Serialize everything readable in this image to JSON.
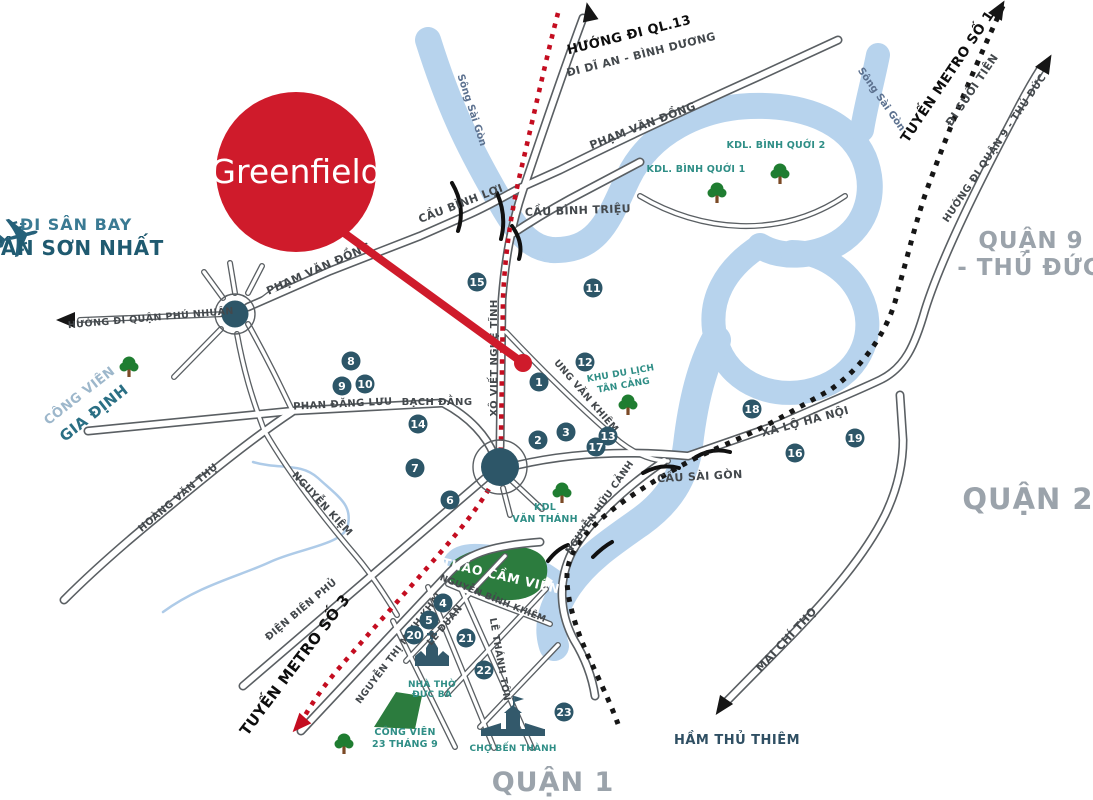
{
  "project": {
    "name": "Greenfield"
  },
  "icons": {
    "airplane": "✈"
  },
  "colors": {
    "accent_red": "#cf1b2b",
    "metro_red": "#c40d20",
    "metro_black": "#161616",
    "river_blue": "#b7d3ed",
    "park_green": "#2c7c3e",
    "marker_teal": "#2d5668",
    "place_teal": "#2f8e86",
    "district_gray": "#9ba3ab"
  },
  "labels": [
    {
      "name": "district-quan-1",
      "t": "QUẬN 1",
      "x": 553,
      "y": 791,
      "r": 0,
      "c": "district",
      "s": 27
    },
    {
      "name": "district-quan-2",
      "t": "QUẬN 2",
      "x": 1028,
      "y": 509,
      "r": 0,
      "c": "district",
      "s": 29
    },
    {
      "name": "district-quan-9-line1",
      "t": "QUẬN 9",
      "x": 1031,
      "y": 248,
      "r": 0,
      "c": "district",
      "s": 23
    },
    {
      "name": "district-quan-9-line2",
      "t": "- THỦ ĐỨC",
      "x": 1029,
      "y": 275,
      "r": 0,
      "c": "district",
      "s": 23
    },
    {
      "name": "airport-direction-line1",
      "t": "ĐI SÂN BAY",
      "x": 76,
      "y": 230,
      "r": 0,
      "c": "tsn1",
      "s": 16,
      "a": "start"
    },
    {
      "name": "airport-direction-line2",
      "t": "TÂN SƠN NHẤT",
      "x": 76,
      "y": 255,
      "r": 0,
      "c": "tsn2",
      "s": 20,
      "a": "start"
    },
    {
      "name": "ql13-direction-line1",
      "t": "HƯỚNG ĐI QL.13",
      "x": 630,
      "y": 39,
      "r": -14,
      "c": "black",
      "s": 13
    },
    {
      "name": "ql13-direction-line2",
      "t": "ĐI DĨ AN - BÌNH DƯƠNG",
      "x": 642,
      "y": 58,
      "r": -14,
      "c": "road",
      "s": 11
    },
    {
      "name": "metro1-label-line1",
      "t": "TUYẾN METRO SỐ 1",
      "x": 951,
      "y": 79,
      "r": -56,
      "c": "black",
      "s": 13.5
    },
    {
      "name": "metro1-label-line2",
      "t": "ĐI SUỐI TIÊN",
      "x": 975,
      "y": 92,
      "r": -56,
      "c": "road",
      "s": 11
    },
    {
      "name": "metro3-label",
      "t": "TUYẾN METRO SỐ 3",
      "x": 299,
      "y": 668,
      "r": -53,
      "c": "black",
      "s": 15
    },
    {
      "name": "quan9-direction",
      "t": "HƯỚNG ĐI QUẬN 9 - THỦ ĐỨC",
      "x": 997,
      "y": 150,
      "r": -56,
      "c": "road",
      "s": 10
    },
    {
      "name": "phu-nhuan-direction",
      "t": "HƯỚNG ĐI QUẬN PHÚ NHUẬN",
      "x": 151,
      "y": 321,
      "r": -5,
      "c": "road",
      "s": 9.5
    },
    {
      "name": "thu-thiem-tunnel-label",
      "t": "HẦM THỦ THIÊM",
      "x": 737,
      "y": 744,
      "r": 0,
      "c": "tunnel",
      "s": 13
    },
    {
      "name": "road-pham-van-dong-1",
      "t": "PHẠM VĂN ĐỒNG",
      "x": 320,
      "y": 272,
      "r": -24,
      "c": "road",
      "s": 11
    },
    {
      "name": "road-pham-van-dong-2",
      "t": "PHẠM VĂN ĐỒNG",
      "x": 644,
      "y": 129,
      "r": -21,
      "c": "road",
      "s": 11
    },
    {
      "name": "bridge-cau-binh-loi",
      "t": "CẦU BÌNH LỢI",
      "x": 462,
      "y": 207,
      "r": -21,
      "c": "road",
      "s": 11
    },
    {
      "name": "bridge-cau-binh-trieu",
      "t": "CẦU BÌNH TRIỆU",
      "x": 578,
      "y": 214,
      "r": -2,
      "c": "road",
      "s": 11
    },
    {
      "name": "road-xo-viet-nghe-tinh",
      "t": "XÔ VIẾT NGHỆ TĨNH",
      "x": 497,
      "y": 358,
      "r": -90,
      "c": "road",
      "s": 10
    },
    {
      "name": "road-phan-dang-luu",
      "t": "PHAN ĐĂNG LƯU",
      "x": 343,
      "y": 407,
      "r": -3,
      "c": "road",
      "s": 10
    },
    {
      "name": "road-bach-dang",
      "t": "BẠCH ĐẰNG",
      "x": 437,
      "y": 405,
      "r": 0,
      "c": "road",
      "s": 10
    },
    {
      "name": "road-hoang-van-thu",
      "t": "HOÀNG VĂN THỤ",
      "x": 180,
      "y": 500,
      "r": -40,
      "c": "road",
      "s": 10
    },
    {
      "name": "road-nguyen-kiem",
      "t": "NGUYỄN KIỆM",
      "x": 320,
      "y": 506,
      "r": 47,
      "c": "road",
      "s": 10
    },
    {
      "name": "road-dien-bien-phu",
      "t": "ĐIỆN BIÊN PHỦ",
      "x": 303,
      "y": 612,
      "r": -40,
      "c": "road",
      "s": 10
    },
    {
      "name": "road-nguyen-thi-minh-khai",
      "t": "NGUYỄN THỊ MINH KHAI",
      "x": 401,
      "y": 650,
      "r": -53,
      "c": "road",
      "s": 9.5
    },
    {
      "name": "road-le-duan",
      "t": "LÊ DUẨN",
      "x": 447,
      "y": 627,
      "r": -50,
      "c": "road",
      "s": 9.5
    },
    {
      "name": "road-nguyen-binh-khiem",
      "t": "NGUYỄN BỈNH KHIÊM",
      "x": 492,
      "y": 601,
      "r": 22,
      "c": "road",
      "s": 9
    },
    {
      "name": "road-le-thanh-ton",
      "t": "LÊ THÁNH TÔN",
      "x": 497,
      "y": 660,
      "r": 80,
      "c": "road",
      "s": 9.5
    },
    {
      "name": "road-ung-van-khiem",
      "t": "UNG VĂN KHIÊM",
      "x": 584,
      "y": 398,
      "r": 49,
      "c": "road",
      "s": 9.5
    },
    {
      "name": "road-nguyen-huu-canh",
      "t": "NGUYỄN HỮU CẢNH",
      "x": 602,
      "y": 509,
      "r": -55,
      "c": "road",
      "s": 9.5
    },
    {
      "name": "bridge-cau-sai-gon",
      "t": "CẦU SÀI GÒN",
      "x": 700,
      "y": 480,
      "r": -3,
      "c": "road",
      "s": 11
    },
    {
      "name": "road-xa-lo-ha-noi",
      "t": "XA LỘ HÀ NỘI",
      "x": 806,
      "y": 425,
      "r": -15,
      "c": "road",
      "s": 11
    },
    {
      "name": "road-mai-chi-tho",
      "t": "MAI CHÍ THỌ",
      "x": 789,
      "y": 642,
      "r": -47,
      "c": "road",
      "s": 11
    },
    {
      "name": "river-song-sai-gon-1",
      "t": "Sông Sài Gòn",
      "x": 469,
      "y": 111,
      "r": 72,
      "c": "river-lb",
      "s": 10
    },
    {
      "name": "river-song-sai-gon-2",
      "t": "Sông Sài Gòn",
      "x": 879,
      "y": 101,
      "r": 55,
      "c": "river-lb",
      "s": 10
    },
    {
      "name": "place-kdl-binh-quoi-1",
      "t": "KDL. BÌNH QUỚI 1",
      "x": 696,
      "y": 172,
      "r": 0,
      "c": "place",
      "s": 9.5
    },
    {
      "name": "place-kdl-binh-quoi-2",
      "t": "KDL. BÌNH QUỚI 2",
      "x": 776,
      "y": 148,
      "r": 0,
      "c": "place",
      "s": 9.5
    },
    {
      "name": "place-kdl-tan-cang-line1",
      "t": "KHU DU LỊCH",
      "x": 621,
      "y": 376,
      "r": -10,
      "c": "place",
      "s": 9
    },
    {
      "name": "place-kdl-tan-cang-line2",
      "t": "TÂN CẢNG",
      "x": 624,
      "y": 388,
      "r": -10,
      "c": "place",
      "s": 9
    },
    {
      "name": "place-kdl-van-thanh-line1",
      "t": "KDL",
      "x": 545,
      "y": 510,
      "r": 0,
      "c": "place",
      "s": 9.5
    },
    {
      "name": "place-kdl-van-thanh-line2",
      "t": "VĂN THÁNH",
      "x": 545,
      "y": 522,
      "r": 0,
      "c": "place",
      "s": 9.5
    },
    {
      "name": "park-thao-cam-vien-label",
      "t": "THẢO CẦM VIÊN",
      "x": 500,
      "y": 580,
      "r": 13,
      "c": "white",
      "s": 12.5
    },
    {
      "name": "park-cong-vien-23-line1",
      "t": "CÔNG VIÊN",
      "x": 405,
      "y": 735,
      "r": 0,
      "c": "place",
      "s": 9.5
    },
    {
      "name": "park-cong-vien-23-line2",
      "t": "23 THÁNG 9",
      "x": 405,
      "y": 747,
      "r": 0,
      "c": "place",
      "s": 9.5
    },
    {
      "name": "place-nha-tho-duc-ba-line1",
      "t": "NHÀ THỜ",
      "x": 432,
      "y": 687,
      "r": 0,
      "c": "place",
      "s": 9
    },
    {
      "name": "place-nha-tho-duc-ba-line2",
      "t": "ĐỨC BÀ",
      "x": 432,
      "y": 697,
      "r": 0,
      "c": "place",
      "s": 9
    },
    {
      "name": "place-cho-ben-thanh-label",
      "t": "CHỢ BẾN THÀNH",
      "x": 513,
      "y": 751,
      "r": 0,
      "c": "place",
      "s": 9
    },
    {
      "name": "park-gia-dinh-line1",
      "t": "CÔNG VIÊN",
      "x": 82,
      "y": 399,
      "r": -38,
      "c": "gd1",
      "s": 13
    },
    {
      "name": "park-gia-dinh-line2",
      "t": "GIA ĐỊNH",
      "x": 97,
      "y": 417,
      "r": -38,
      "c": "gd2",
      "s": 15
    }
  ],
  "markers": [
    {
      "n": "1",
      "x": 539,
      "y": 382
    },
    {
      "n": "2",
      "x": 538,
      "y": 440
    },
    {
      "n": "3",
      "x": 566,
      "y": 432
    },
    {
      "n": "4",
      "x": 443,
      "y": 603
    },
    {
      "n": "5",
      "x": 429,
      "y": 620
    },
    {
      "n": "6",
      "x": 450,
      "y": 500
    },
    {
      "n": "7",
      "x": 415,
      "y": 468
    },
    {
      "n": "8",
      "x": 351,
      "y": 361
    },
    {
      "n": "9",
      "x": 342,
      "y": 386
    },
    {
      "n": "10",
      "x": 365,
      "y": 384
    },
    {
      "n": "11",
      "x": 593,
      "y": 288
    },
    {
      "n": "12",
      "x": 585,
      "y": 362
    },
    {
      "n": "13",
      "x": 608,
      "y": 436
    },
    {
      "n": "14",
      "x": 418,
      "y": 424
    },
    {
      "n": "15",
      "x": 477,
      "y": 282
    },
    {
      "n": "16",
      "x": 795,
      "y": 453
    },
    {
      "n": "17",
      "x": 596,
      "y": 447
    },
    {
      "n": "18",
      "x": 752,
      "y": 409
    },
    {
      "n": "19",
      "x": 855,
      "y": 438
    },
    {
      "n": "20",
      "x": 414,
      "y": 635
    },
    {
      "n": "21",
      "x": 466,
      "y": 638
    },
    {
      "n": "22",
      "x": 484,
      "y": 670
    },
    {
      "n": "23",
      "x": 564,
      "y": 712
    }
  ],
  "trees": [
    {
      "name": "tree-gia-dinh",
      "x": 129,
      "y": 366
    },
    {
      "name": "tree-binh-quoi-1",
      "x": 717,
      "y": 192
    },
    {
      "name": "tree-binh-quoi-2",
      "x": 780,
      "y": 173
    },
    {
      "name": "tree-tan-cang",
      "x": 628,
      "y": 404
    },
    {
      "name": "tree-van-thanh",
      "x": 562,
      "y": 492
    },
    {
      "name": "tree-cong-vien-23",
      "x": 344,
      "y": 743
    }
  ]
}
